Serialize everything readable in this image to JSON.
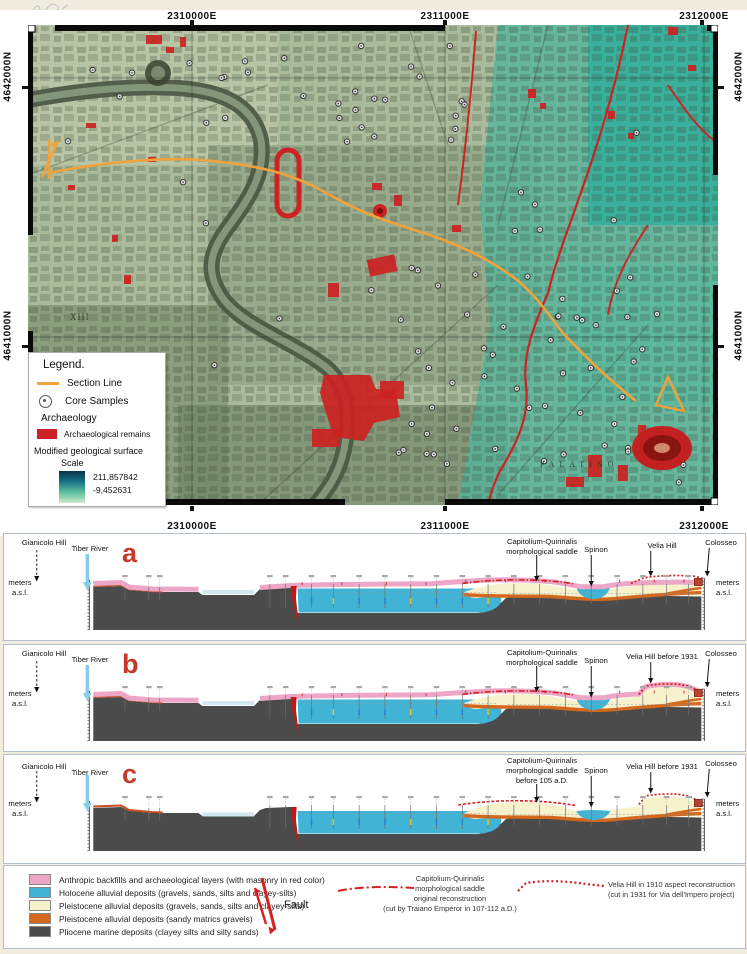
{
  "colors": {
    "pink": "#eda6c6",
    "cyan": "#41b3d5",
    "cream": "#f7f1cc",
    "orange": "#d4691e",
    "gray": "#4b4b4b",
    "red": "#cc2020",
    "section_line": "#f2a23a"
  },
  "map": {
    "coords_e": [
      "2310000E",
      "2311000E",
      "2312000E"
    ],
    "coords_n": [
      "4642000N",
      "4641000N"
    ],
    "palatino": "PALATINO",
    "district": "XIII",
    "legend": {
      "title": "Legend.",
      "section_line": "Section Line",
      "core_samples": "Core Samples",
      "archaeology": "Archaeology",
      "remains": "Archaeological remains",
      "surface": "Modified geological surface",
      "scale": "Scale",
      "scale_max": "211,857842",
      "scale_min": "-9,452631"
    }
  },
  "sections": [
    {
      "letter": "a",
      "gianicolo": "Gianicolo Hill",
      "tiber": "Tiber River",
      "saddle": "Capitolium-Quirinalis\nmorphological saddle",
      "spinon": "Spinon",
      "velia": "Velia Hill",
      "colosseo": "Colosseo",
      "meters_asl": "meters\na.s.l."
    },
    {
      "letter": "b",
      "gianicolo": "Gianicolo Hill",
      "tiber": "Tiber River",
      "saddle": "Capitolium-Quirinalis\nmorphological saddle",
      "spinon": "Spinon",
      "velia": "Velia Hill before 1931",
      "colosseo": "Colosseo",
      "meters_asl": "meters\na.s.l."
    },
    {
      "letter": "c",
      "gianicolo": "Gianicolo Hill",
      "tiber": "Tiber River",
      "saddle": "Capitolium-Quirinalis\nmorphological saddle\nbefore 105 a.D.",
      "spinon": "Spinon",
      "velia": "Velia Hill before 1931",
      "colosseo": "Colosseo",
      "meters_asl": "meters\na.s.l."
    }
  ],
  "bottom_legend": {
    "items": [
      {
        "color": "#eda6c6",
        "label": "Anthropic backfills and archaeological layers (with masonry in red color)"
      },
      {
        "color": "#41b3d5",
        "label": "Holocene alluvial deposits (gravels, sands, silts and clayey-silts)"
      },
      {
        "color": "#f7f1cc",
        "label": "Pleistocene alluvial deposits (gravels, sands, silts and clayey-silts)"
      },
      {
        "color": "#d4691e",
        "label": "Pleistocene alluvial deposits (sandy matrics gravels)"
      },
      {
        "color": "#4b4b4b",
        "label": "Pliocene marine deposits (clayey silts and silty sands)"
      }
    ],
    "fault": "Fault",
    "saddle_caption": "Capitolium-Quirinalis\nmorphological saddle\noriginal reconstruction\n(cut by Traiano Emperor in 107-112 a.D.)",
    "velia_caption": "Velia Hill in 1910 aspect reconstruction\n(cut in 1931 for Via dell'Impero project)"
  }
}
